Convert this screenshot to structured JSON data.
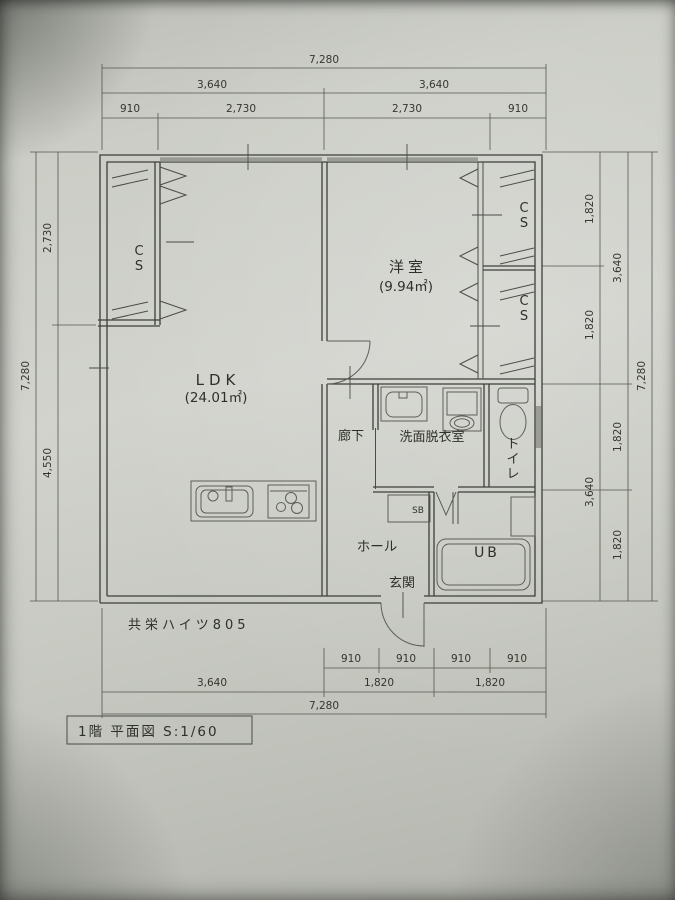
{
  "drawing": {
    "building_label": "共栄ハイツ805",
    "title_block": "1階 平面図 S:1/60"
  },
  "rooms": {
    "ldk": {
      "name": "LDK",
      "area": "(24.01㎡)"
    },
    "western_room": {
      "name": "洋室",
      "area": "(9.94㎡)"
    },
    "corridor": "廊下",
    "washroom": "洗面脱衣室",
    "toilet": "トイレ",
    "hall": "ホール",
    "entrance": "玄関",
    "unit_bath": "UB",
    "shoe_box": "SB",
    "closet_left": "CS",
    "closet_right_top": "CS",
    "closet_right_bottom": "CS"
  },
  "dimensions": {
    "top": [
      "7,280",
      "3,640",
      "3,640",
      "910",
      "2,730",
      "2,730",
      "910"
    ],
    "bottom": [
      "910",
      "910",
      "910",
      "910",
      "3,640",
      "1,820",
      "1,820",
      "7,280"
    ],
    "left": [
      "2,730",
      "4,550",
      "7,280"
    ],
    "right": [
      "1,820",
      "1,820",
      "3,640",
      "3,640",
      "1,820",
      "1,820",
      "7,280"
    ]
  },
  "colors": {
    "paper": "#cbcdc6",
    "line": "#3d3f3b",
    "dim_line": "#55574f"
  }
}
